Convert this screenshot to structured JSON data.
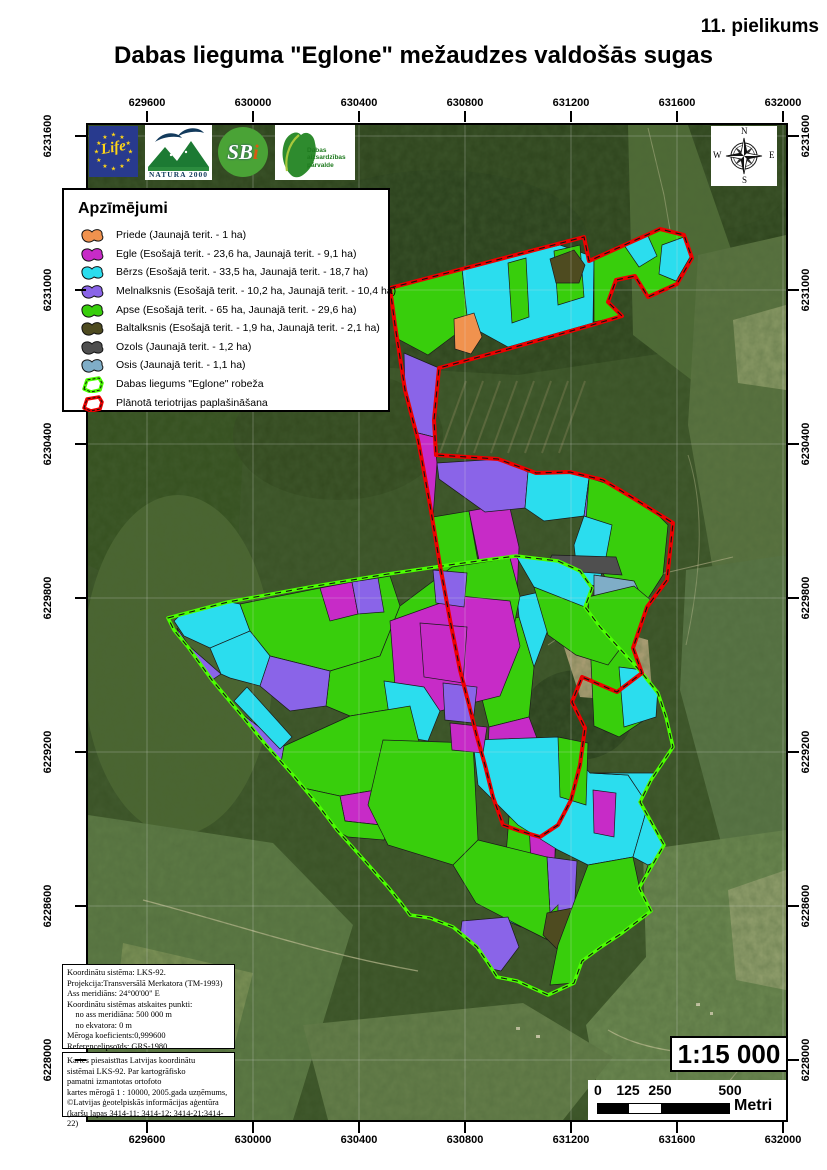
{
  "page": {
    "annotation": "11. pielikums",
    "title": "Dabas lieguma \"Eglone\" mežaudzes valdošās sugas"
  },
  "axes": {
    "x": {
      "labels": [
        "629600",
        "630000",
        "630400",
        "630800",
        "631200",
        "631600",
        "632000"
      ],
      "page_x": [
        147,
        253,
        359,
        465,
        571,
        677,
        783
      ]
    },
    "y": {
      "labels": [
        "6231600",
        "6231000",
        "6230400",
        "6229800",
        "6229200",
        "6228600",
        "6228000"
      ],
      "page_y": [
        136,
        290,
        444,
        598,
        752,
        906,
        1060
      ]
    }
  },
  "legend": {
    "title": "Apzīmējumi",
    "items": [
      {
        "key": "priede",
        "type": "patch",
        "label": "Priede (Jaunajā terit. - 1 ha)"
      },
      {
        "key": "egle",
        "type": "patch",
        "label": "Egle (Esošajā terit. - 23,6 ha, Jaunajā terit. - 9,1 ha)"
      },
      {
        "key": "berzs",
        "type": "patch",
        "label": "Bērzs (Esošajā terit. - 33,5 ha, Jaunajā terit. - 18,7 ha)"
      },
      {
        "key": "melnalksnis",
        "type": "patch",
        "label": "Melnalksnis (Esošajā terit. - 10,2 ha, Jaunajā terit. - 10,4 ha)"
      },
      {
        "key": "apse",
        "type": "patch",
        "label": "Apse (Esošajā terit. - 65 ha, Jaunajā terit. - 29,6 ha)"
      },
      {
        "key": "baltalksnis",
        "type": "patch",
        "label": "Baltalksnis (Esošajā terit. - 1,9 ha, Jaunajā terit. - 2,1 ha)"
      },
      {
        "key": "ozols",
        "type": "patch",
        "label": "Ozols (Jaunajā terit. - 1,2 ha)"
      },
      {
        "key": "osis",
        "type": "patch",
        "label": "Osis (Jaunajā terit. - 1,1 ha)"
      },
      {
        "key": "reserve",
        "type": "outline",
        "color": "#4CFF00",
        "label": "Dabas liegums \"Eglone\" robeža"
      },
      {
        "key": "extension",
        "type": "outline",
        "color": "#EE0000",
        "label": "Plānotā teriotrijas paplašināšana"
      }
    ]
  },
  "logos": {
    "life": {
      "text": "Life"
    },
    "natura": {
      "text": "NATURA 2000"
    },
    "sbi": {
      "sb": "SB",
      "i": "i"
    },
    "dap": {
      "lines": [
        "Dabas",
        "aizsardzības",
        "pārvalde"
      ]
    }
  },
  "compass": {
    "n": "N",
    "e": "E",
    "s": "S",
    "w": "W"
  },
  "info_box_1": {
    "lines": [
      "Koordinātu sistēma: LKS-92.",
      "Projekcija:Transversālā Merkatora (TM-1993)",
      "Ass meridiāns: 24°00'00\" E",
      "Koordinātu sistēmas atskaites punkti:",
      "    no ass meridiāna: 500 000 m",
      "    no ekvatora: 0 m",
      "Mēroga koeficients:0,999600",
      "Referencelipsoīds: GRS-1980"
    ]
  },
  "info_box_2": {
    "lines": [
      "Kartes piesaistītas Latvijas koordinātu",
      "sistēmai LKS-92. Par kartogrāfisko",
      "pamatni izmantotas ortofoto",
      "kartes mērogā  1 : 10000, 2005.gada uzņēmums,",
      "©Latvijas ģeotelpiskās informācijas aģentūra",
      "(karšu lapas 3414-11; 3414-12; 3414-21;3414-22)"
    ]
  },
  "scale": {
    "ratio": "1:15 000",
    "bar_labels": [
      "0",
      "125",
      "250",
      "500"
    ],
    "bar_label_x": [
      9,
      40,
      72,
      142
    ],
    "unit": "Metri"
  },
  "map": {
    "species_colors": {
      "priede": "#F0924E",
      "egle": "#C72BC7",
      "berzs": "#2BDDEE",
      "melnalksnis": "#8A64E8",
      "apse": "#38CE0C",
      "baltalksnis": "#4E4B20",
      "ozols": "#4F4F4F",
      "osis": "#7FADC7"
    },
    "boundaries": [
      {
        "name": "reserve",
        "color": "#4CFF00",
        "width": 3.5,
        "path": "M80,493 L140,477 L222,462 L300,449 L368,439 L428,431 L470,436 L492,446 L504,463 L497,482 L512,502 L532,524 L554,548 L570,568 L578,592 L585,622 L563,655 L552,677 L576,720 L551,763 L563,786 L534,808 L513,822 L494,836 L486,858 L460,870 L429,856 L409,852 L400,838 L389,822 L365,802 L342,793 L322,790 L313,778 L300,762 L276,735 L249,705 L230,680 L205,650 L178,620 L155,592 L124,555 L100,522 L86,505 Z"
      },
      {
        "name": "extension",
        "color": "#EE0000",
        "width": 4,
        "path": "M302,163 L496,112 L501,136 L572,104 L596,110 L604,133 L589,159 L560,172 L547,151 L528,155 L520,177 L534,191 L504,200 L420,224 L351,243 L346,295 L348,330 L410,334 L448,348 L482,347 L515,355 L545,373 L585,398 L579,455 L559,482 L545,523 L554,548 L529,567 L494,552 L484,577 L497,603 L492,640 L483,675 L470,700 L452,712 L432,706 L415,700 L405,672 L397,640 L389,612 L381,580 L372,545 L362,495 L352,440 L342,380 L334,336 L330,315 L317,265 L307,200 Z"
      }
    ],
    "polygons": [
      {
        "s": "apse",
        "p": "302,160 374,143 380,200 340,230 310,214"
      },
      {
        "s": "berzs",
        "p": "374,143 472,120 506,132 505,198 420,222 380,200"
      },
      {
        "s": "apse",
        "p": "420,138 438,133 441,192 424,198"
      },
      {
        "s": "apse",
        "p": "466,126 492,120 496,172 470,180"
      },
      {
        "s": "priede",
        "p": "366,194 386,188 394,212 383,229 367,224"
      },
      {
        "s": "baltalksnis",
        "p": "462,134 486,125 497,140 491,158 468,158"
      },
      {
        "s": "apse",
        "p": "506,132 572,104 597,110 604,133 589,159 561,172 547,151 529,155 521,177 534,191 506,197"
      },
      {
        "s": "berzs",
        "p": "536,120 560,111 569,131 551,142"
      },
      {
        "s": "berzs",
        "p": "574,120 596,112 602,132 588,156 571,149"
      },
      {
        "s": "melnalksnis",
        "p": "316,228 351,243 346,312 318,305"
      },
      {
        "s": "egle",
        "p": "318,305 346,312 349,338 345,392 328,396 320,350"
      },
      {
        "s": "apse",
        "p": "345,392 381,386 391,442 396,502 391,562 371,556 357,480 350,432"
      },
      {
        "s": "egle",
        "p": "381,386 421,379 431,422 429,472 401,476 392,440"
      },
      {
        "s": "apse",
        "p": "396,502 431,492 446,542 441,592 401,602 391,562"
      },
      {
        "s": "berzs",
        "p": "429,472 456,466 461,502 446,542 431,492"
      },
      {
        "s": "egle",
        "p": "401,602 441,592 456,632 451,682 421,692 399,652"
      },
      {
        "s": "apse",
        "p": "421,692 451,682 468,722 463,762 434,756 418,730"
      },
      {
        "s": "berzs",
        "p": "434,756 463,762 456,792 433,802 417,795 421,770"
      },
      {
        "s": "apse",
        "p": "456,632 485,640 480,690 468,722 451,682"
      },
      {
        "s": "melnalksnis",
        "p": "349,338 412,334 440,347 437,383 397,387 351,354"
      },
      {
        "s": "berzs",
        "p": "440,347 483,347 501,353 496,391 456,396 437,383"
      },
      {
        "s": "melnalksnis",
        "p": "501,353 541,361 537,401 496,391"
      },
      {
        "s": "baltalksnis",
        "p": "505,340 545,334 557,352 549,372 513,368"
      },
      {
        "s": "apse",
        "p": "501,353 530,362 560,380 580,400 575,450 557,478 544,518 530,500 522,464 507,430 498,396"
      },
      {
        "s": "berzs",
        "p": "496,391 524,400 518,432 510,462 490,456 486,420"
      },
      {
        "s": "ozols",
        "p": "464,430 528,432 534,450 478,446 458,442"
      },
      {
        "s": "osis",
        "p": "506,450 546,456 554,472 538,488 506,472"
      },
      {
        "s": "apse",
        "p": "500,472 546,461 571,482 577,542 561,592 531,612 506,601"
      },
      {
        "s": "berzs",
        "p": "531,542 571,547 568,592 536,602"
      },
      {
        "s": "berzs",
        "p": "86,496 112,471 152,479 162,506 122,523 96,511"
      },
      {
        "s": "melnalksnis",
        "p": "89,503 101,521 133,549 121,557 93,516"
      },
      {
        "s": "apse",
        "p": "152,479 232,463 302,451 312,481 292,531 242,546 182,531 162,506"
      },
      {
        "s": "egle",
        "p": "232,463 264,457 270,489 242,496"
      },
      {
        "s": "melnalksnis",
        "p": "264,457 290,453 296,487 270,489"
      },
      {
        "s": "berzs",
        "p": "162,506 182,531 172,561 142,553 133,549 122,523"
      },
      {
        "s": "apse",
        "p": "242,546 292,531 312,481 364,442 422,433 432,471 422,521 372,561 322,581 262,591 238,581"
      },
      {
        "s": "egle",
        "p": "302,496 372,471 422,476 432,521 412,571 352,586 307,561"
      },
      {
        "s": "melnalksnis",
        "p": "182,531 242,546 238,581 202,586 172,561"
      },
      {
        "s": "berzs",
        "p": "296,556 336,562 352,586 340,616 304,610"
      },
      {
        "s": "melnalksnis",
        "p": "142,580 196,621 189,661 151,641"
      },
      {
        "s": "apse",
        "p": "196,621 262,591 322,581 332,621 312,661 252,671 206,661 189,661"
      },
      {
        "s": "egle",
        "p": "252,671 312,661 332,621 372,641 362,691 302,701 257,696"
      },
      {
        "s": "berzs",
        "p": "159,562 204,612 192,624 146,576"
      },
      {
        "s": "apse",
        "p": "189,661 206,661 252,671 257,696 302,701 296,715 260,712 220,690"
      },
      {
        "s": "berzs",
        "p": "352,642 382,646 380,712 352,712 330,690 336,652"
      },
      {
        "s": "apse",
        "p": "295,615 385,618 390,715 365,740 300,720 280,680"
      },
      {
        "s": "egle",
        "p": "439,658 469,662 466,762 444,758"
      },
      {
        "s": "berzs",
        "p": "385,615 470,612 502,648 540,650 560,680 545,732 500,740 470,725 430,700 390,660"
      },
      {
        "s": "apse",
        "p": "470,612 500,618 498,680 472,672"
      },
      {
        "s": "egle",
        "p": "505,665 528,668 526,712 506,708"
      },
      {
        "s": "berzs",
        "p": "502,648 608,648 600,725 560,740 545,732 560,680 540,650"
      },
      {
        "s": "egle",
        "p": "602,725 622,727 618,762 598,758"
      },
      {
        "s": "apse",
        "p": "560,740 600,725 598,758 575,790 552,765"
      },
      {
        "s": "melnalksnis",
        "p": "459,732 489,736 486,792 462,788"
      },
      {
        "s": "apse",
        "p": "390,715 459,732 462,788 470,780 470,820 430,800 388,778 365,740"
      },
      {
        "s": "baltalksnis",
        "p": "459,788 500,780 525,800 510,835 470,825 455,810"
      },
      {
        "s": "baltalksnis",
        "p": "545,772 572,774 570,797 550,800"
      },
      {
        "s": "melnalksnis",
        "p": "374,796 420,792 431,822 413,846 386,840 371,820"
      },
      {
        "s": "apse",
        "p": "500,740 545,732 552,765 563,786 534,808 513,822 494,836 486,858 462,860 470,820"
      },
      {
        "s": "berzs",
        "p": "428,431 470,436 492,446 504,463 497,482 468,478 446,462"
      },
      {
        "s": "apse",
        "p": "446,462 497,482 512,502 532,524 520,540 488,530 460,510"
      },
      {
        "s": "melnalksnis",
        "p": "345,445 379,448 376,482 348,478"
      },
      {
        "s": "egle",
        "p": "332,498 379,502 375,558 336,552"
      },
      {
        "s": "melnalksnis",
        "p": "355,558 389,562 385,598 357,595"
      },
      {
        "s": "egle",
        "p": "362,598 399,602 395,628 364,625"
      }
    ]
  }
}
